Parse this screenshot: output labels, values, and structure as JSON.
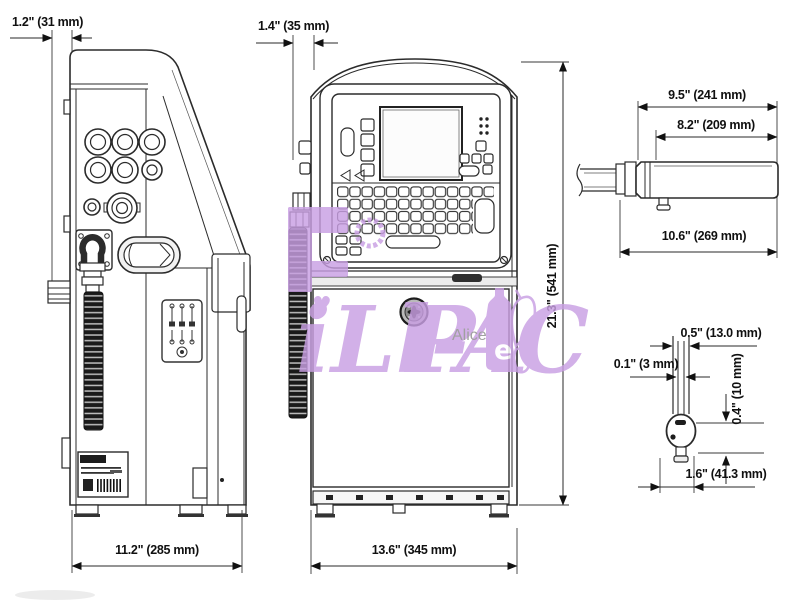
{
  "watermark": {
    "script": "iLl-",
    "script2": "PAC",
    "bottle_letter": "e",
    "alice": "Alice",
    "heart": "♥",
    "purple": "#c99fe3",
    "gray": "#8c8c8c"
  },
  "side_view": {
    "dim_top": "1.2\" (31 mm)",
    "dim_bottom": "11.2\" (285 mm)"
  },
  "front_view": {
    "dim_top": "1.4\" (35 mm)",
    "dim_bottom": "13.6\" (345 mm)",
    "dim_height": "21.3\" (541 mm)"
  },
  "printhead_side_view": {
    "dim_outer": "9.5\" (241 mm)",
    "dim_inner": "8.2\" (209 mm)",
    "dim_total": "10.6\" (269 mm)"
  },
  "printhead_front_view": {
    "dim_width": "0.5\" (13.0 mm)",
    "dim_inner": "0.1\" (3 mm)",
    "dim_vertical": "0.4\" (10 mm)",
    "dim_bottom": "1.6\" (41.3 mm)"
  }
}
